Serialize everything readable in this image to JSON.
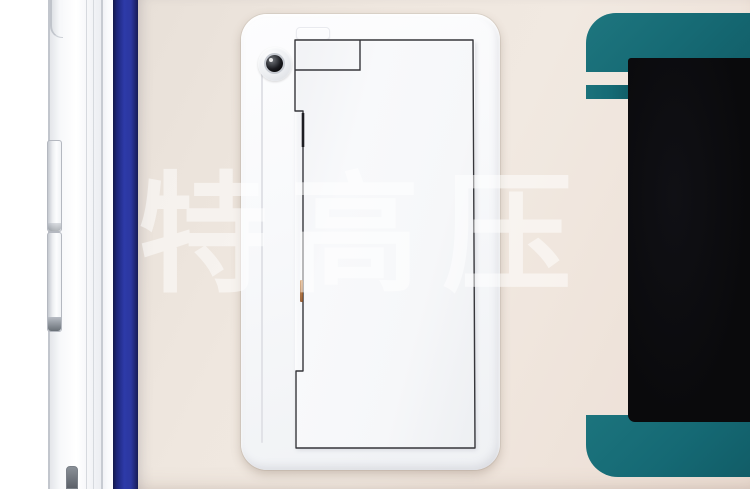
{
  "watermark": {
    "text": "特高压"
  },
  "display": {
    "vent_stripe_count": 13,
    "screen_state": "off"
  },
  "colors": {
    "bezel_teal": "#176b74",
    "accent_blue": "#2b35a7",
    "panel_beige": "#ece4dc",
    "screen_black": "#0b0b0d",
    "cover_white": "#f8f9fa",
    "rust_mark": "#a85c26"
  }
}
